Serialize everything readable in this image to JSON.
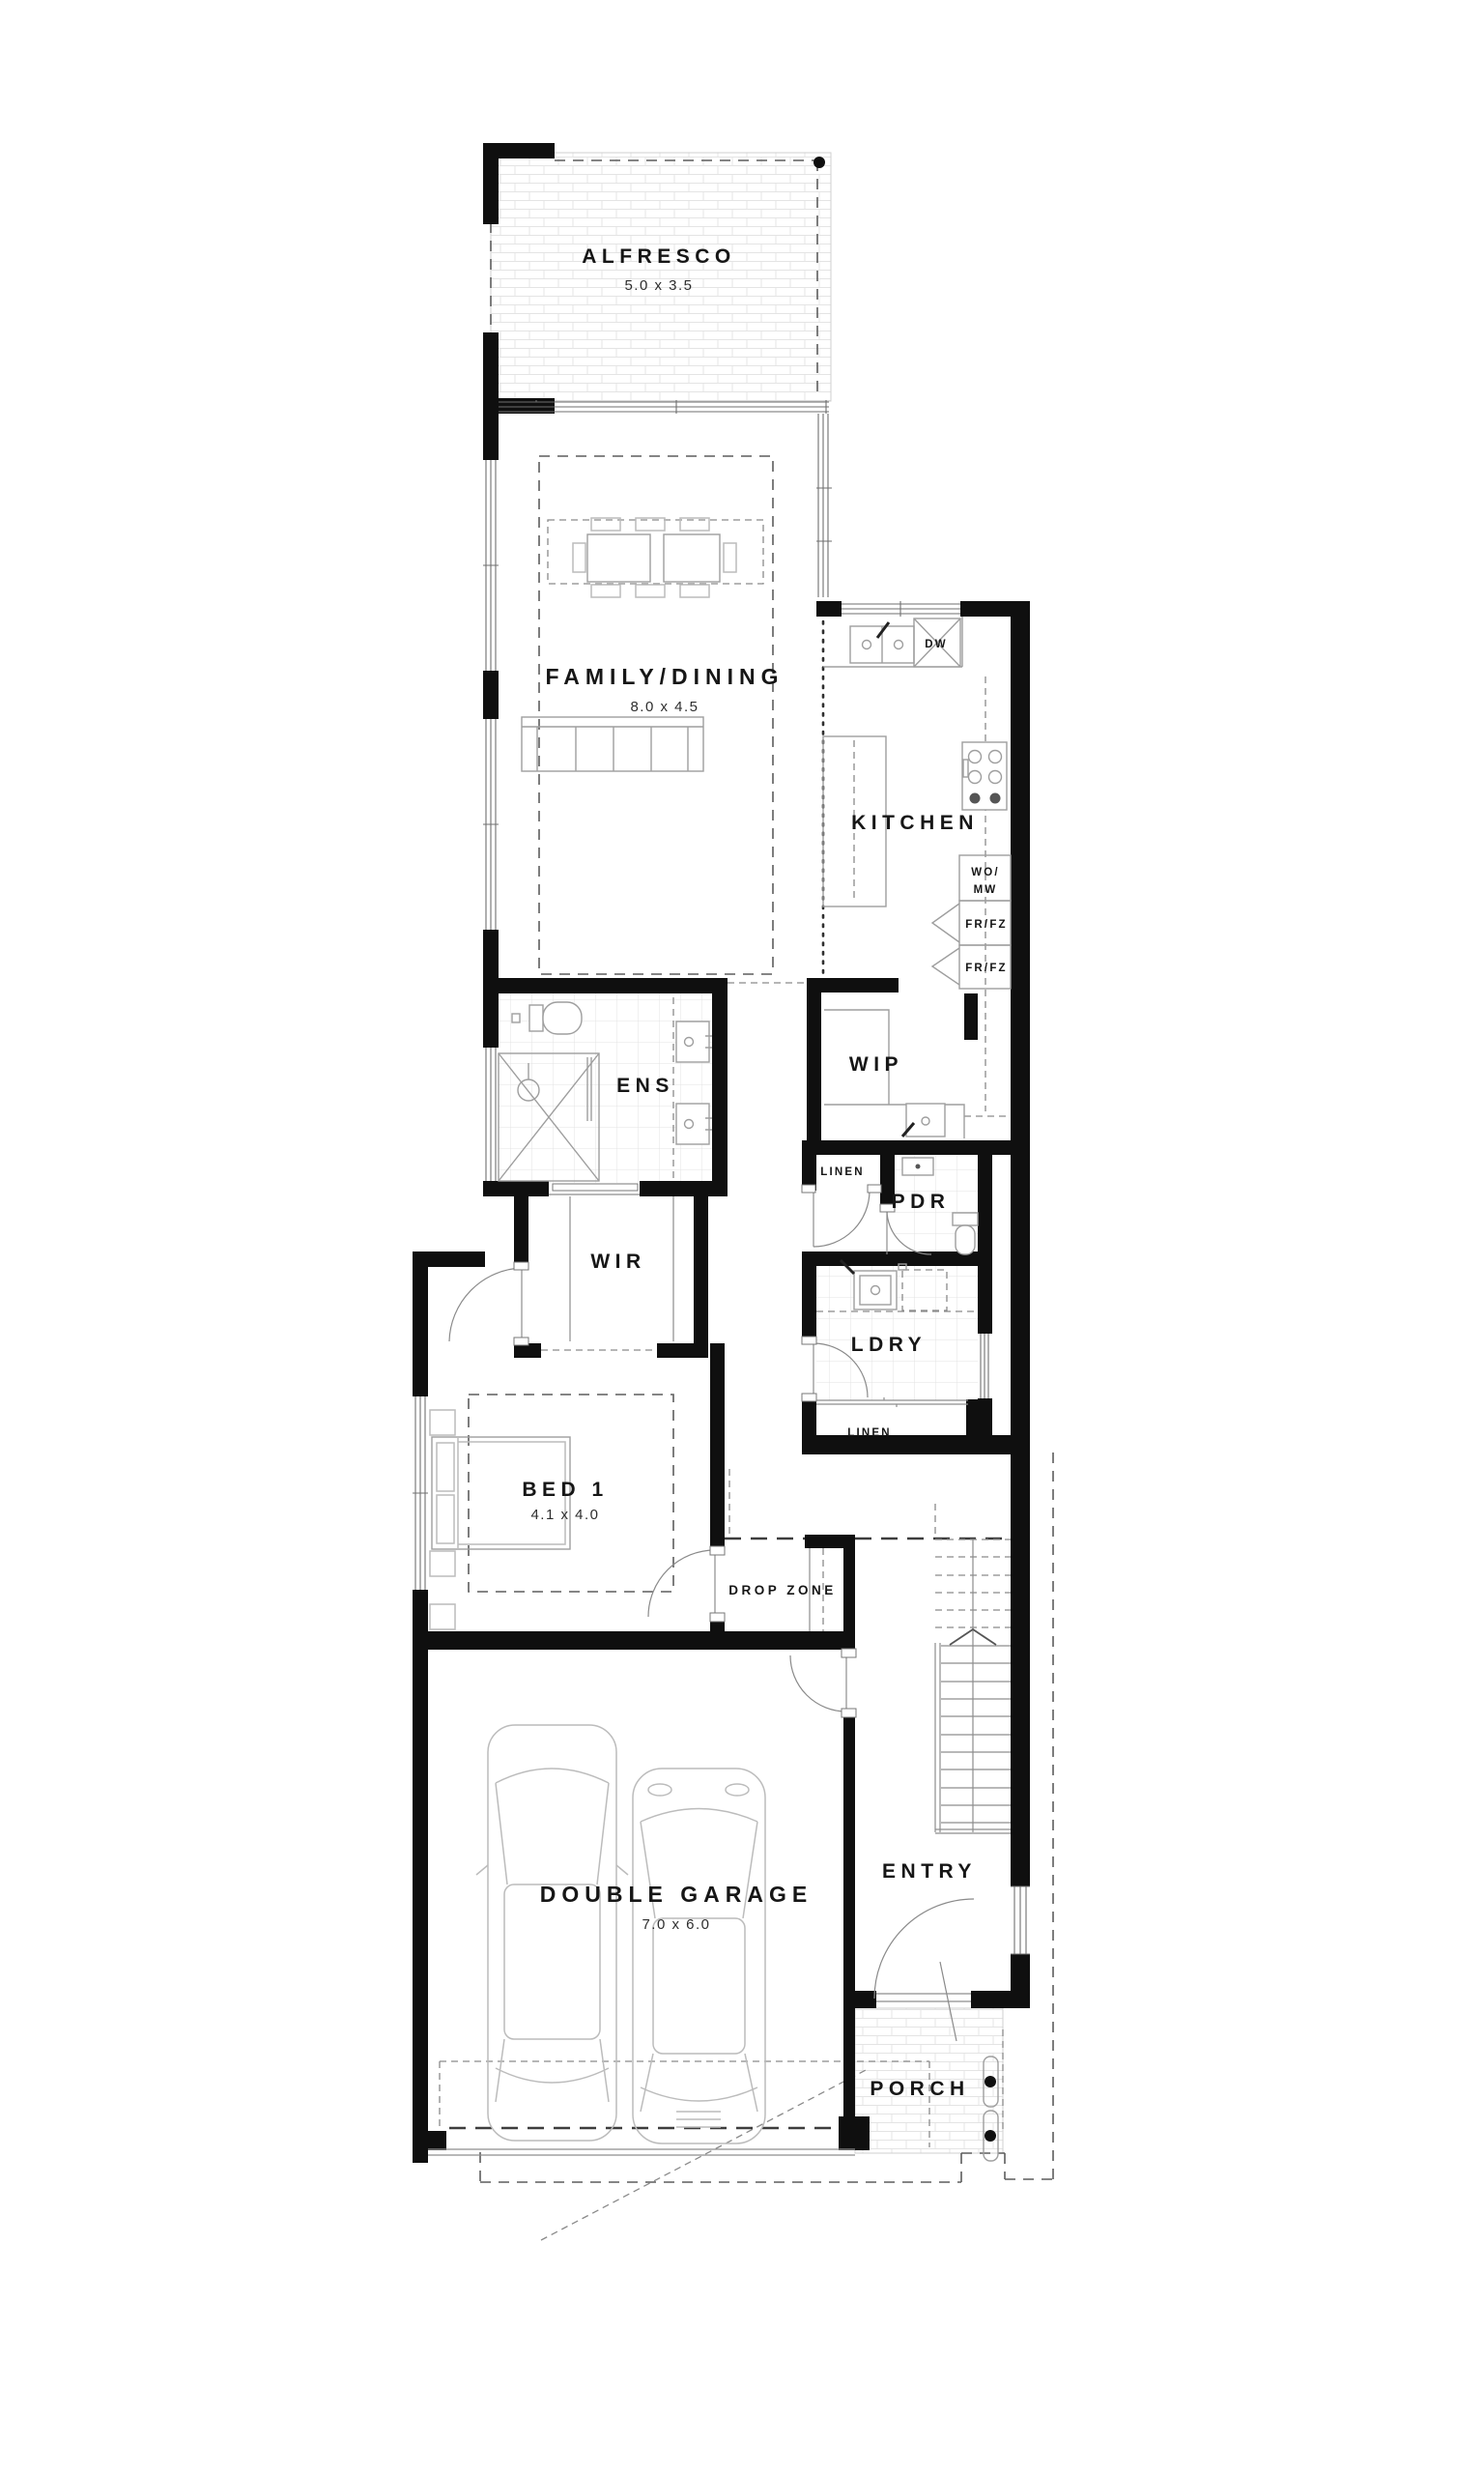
{
  "plan_title": "Single storey floor plan (ground floor)",
  "colors": {
    "wall": "#0f0f0f",
    "background": "#ffffff",
    "furniture_line": "#9e9e9e",
    "tile_line": "#e3e3e3",
    "dash_line": "#5d5d5d",
    "text": "#161616"
  },
  "rooms": {
    "alfresco": {
      "name": "ALFRESCO",
      "dims": "5.0 x 3.5"
    },
    "family_dining": {
      "name": "FAMILY/DINING",
      "dims": "8.0 x 4.5"
    },
    "kitchen": {
      "name": "KITCHEN"
    },
    "ens": {
      "name": "ENS"
    },
    "wip": {
      "name": "WIP"
    },
    "linen_upper": {
      "name": "LINEN"
    },
    "pdr": {
      "name": "PDR"
    },
    "wir": {
      "name": "WIR"
    },
    "ldry": {
      "name": "LDRY"
    },
    "linen_lower": {
      "name": "LINEN"
    },
    "bed1": {
      "name": "BED 1",
      "dims": "4.1 x 4.0"
    },
    "drop_zone": {
      "name": "DROP ZONE"
    },
    "garage": {
      "name": "DOUBLE GARAGE",
      "dims": "7.0 x 6.0"
    },
    "entry": {
      "name": "ENTRY"
    },
    "porch": {
      "name": "PORCH"
    }
  },
  "appliances": {
    "dishwasher": "DW",
    "wall_oven_line1": "WO/",
    "wall_oven_line2": "MW",
    "fridge_top": "FR/FZ",
    "fridge_bottom": "FR/FZ"
  }
}
